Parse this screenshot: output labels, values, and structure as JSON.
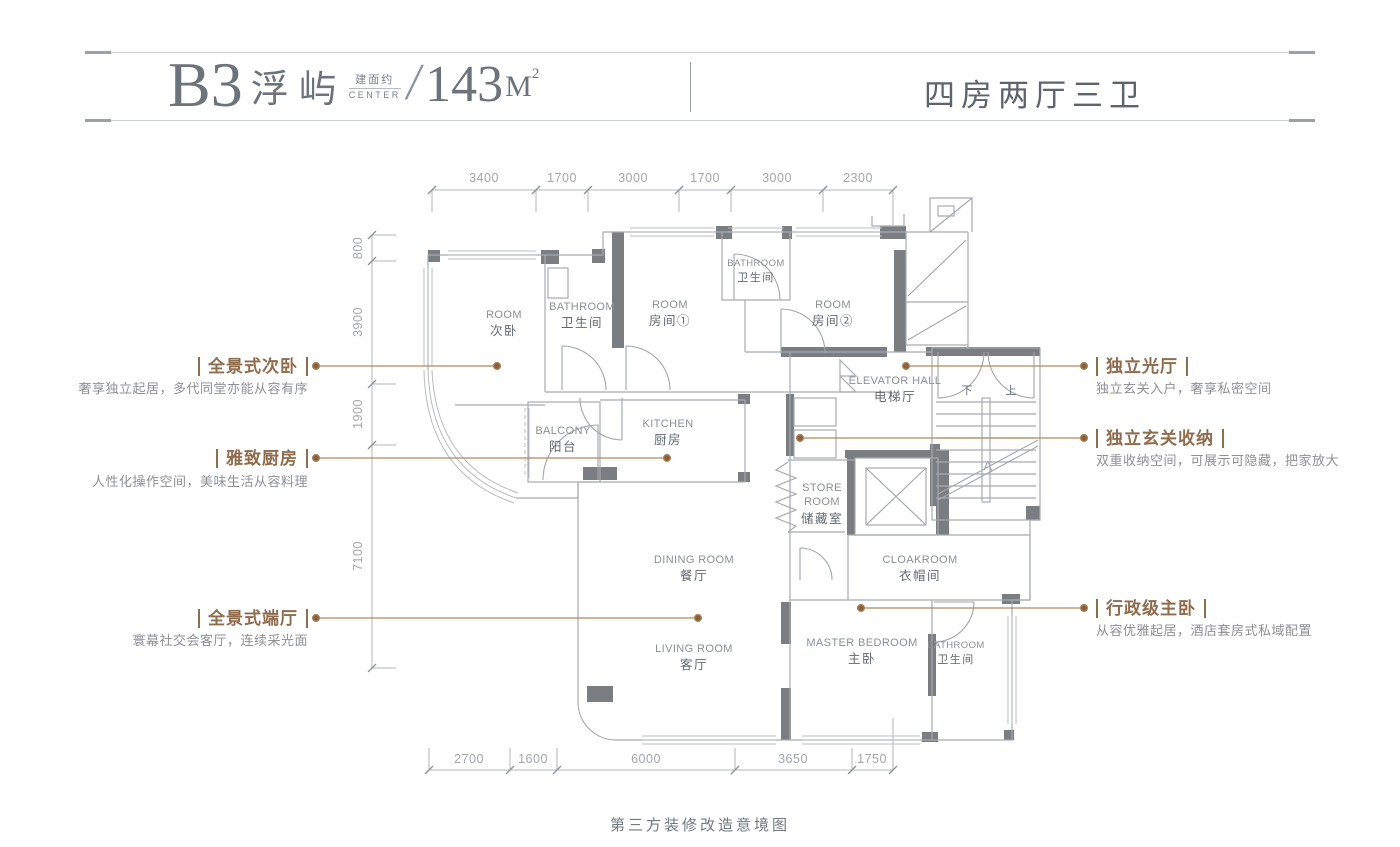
{
  "header": {
    "unit_code": "B3",
    "unit_name": "浮屿",
    "area_label": "建面约",
    "brand": "CENTER",
    "slash": "/",
    "area_number": "143",
    "area_unit": "M",
    "area_exponent": "2",
    "rooms_summary": "四房两厅三卫"
  },
  "callouts": {
    "left": [
      {
        "title": "全景式次卧",
        "subtitle": "奢享独立起居，多代同堂亦能从容有序"
      },
      {
        "title": "雅致厨房",
        "subtitle": "人性化操作空间，美味生活从容料理"
      },
      {
        "title": "全景式端厅",
        "subtitle": "寰幕社交会客厅，连续采光面"
      }
    ],
    "right": [
      {
        "title": "独立光厅",
        "subtitle": "独立玄关入户，奢享私密空间"
      },
      {
        "title": "独立玄关收纳",
        "subtitle": "双重收纳空间，可展示可隐藏，把家放大"
      },
      {
        "title": "行政级主卧",
        "subtitle": "从容优雅起居，酒店套房式私域配置"
      }
    ]
  },
  "rooms": [
    {
      "en": "ROOM",
      "zh": "次卧"
    },
    {
      "en": "BATHROOM",
      "zh": "卫生间"
    },
    {
      "en": "ROOM",
      "zh": "房间①"
    },
    {
      "en": "BATHROOM",
      "zh": "卫生间"
    },
    {
      "en": "ROOM",
      "zh": "房间②"
    },
    {
      "en": "ELEVATOR HALL",
      "zh": "电梯厅"
    },
    {
      "en": "BALCONY",
      "zh": "阳台"
    },
    {
      "en": "KITCHEN",
      "zh": "厨房"
    },
    {
      "en": "STORE ROOM",
      "zh": "储藏室"
    },
    {
      "en": "CLOAKROOM",
      "zh": "衣帽间"
    },
    {
      "en": "DINING ROOM",
      "zh": "餐厅"
    },
    {
      "en": "LIVING ROOM",
      "zh": "客厅"
    },
    {
      "en": "MASTER BEDROOM",
      "zh": "主卧"
    },
    {
      "en": "BATHROOM",
      "zh": "卫生间"
    }
  ],
  "stairs": {
    "down": "下",
    "up": "上"
  },
  "dimensions": {
    "top": [
      "3400",
      "1700",
      "3000",
      "1700",
      "3000",
      "2300"
    ],
    "left": [
      "800",
      "3900",
      "1900",
      "7100"
    ],
    "bottom": [
      "2700",
      "1600",
      "6000",
      "3650",
      "1750"
    ]
  },
  "caption": "第三方装修改造意境图",
  "colors": {
    "accent_brown": "#8f6c4c",
    "leader_line": "#b08a5e",
    "wall_dark": "#7a7d81",
    "wall_line": "#a6abb0",
    "dim_text": "#a2a7ab",
    "header_text": "#6d737b"
  }
}
